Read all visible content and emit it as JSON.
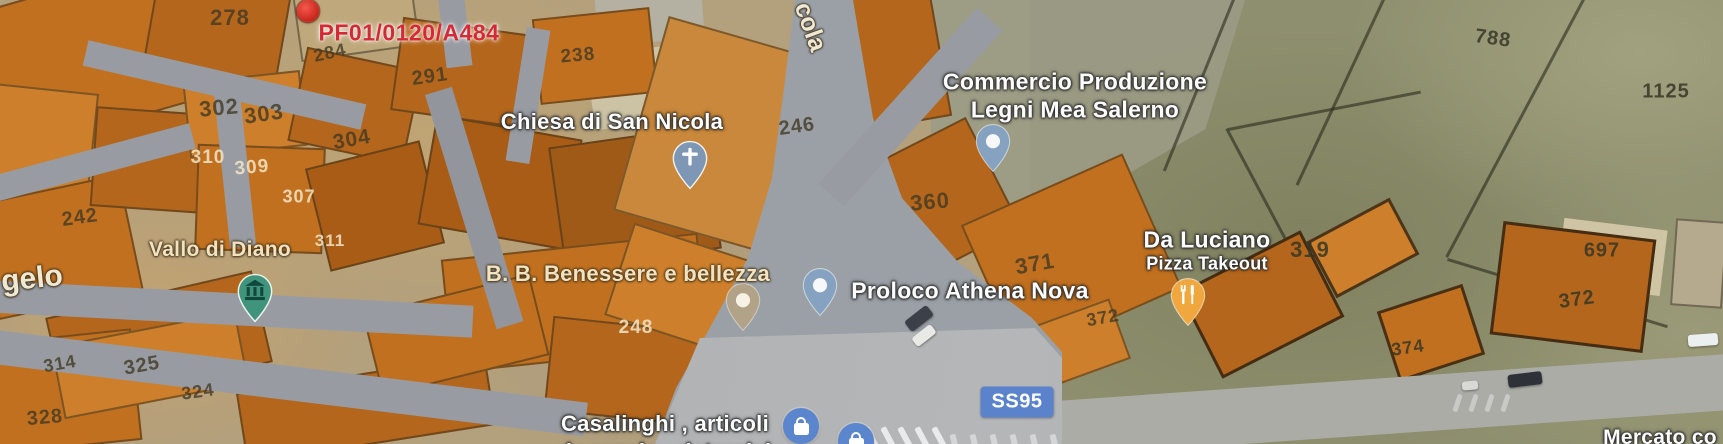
{
  "map": {
    "annotation": {
      "label": "PF01/0120/A484",
      "x": 409,
      "y": 33
    },
    "marker_red": {
      "x": 308,
      "y": 11
    },
    "road_badge": {
      "text": "SS95",
      "x": 1017,
      "y": 402
    },
    "colors": {
      "selected_label": "#d42a35",
      "road_badge_bg": "#5b83cb",
      "shop_icon_bg": "#5b85cd",
      "restaurant_pin": "#efa73e",
      "museum_pin": "#3f947b",
      "church_pin": "#7e97b5",
      "business_pin": "#85a2c0",
      "area_pin": "#b2a287",
      "parcel_fill": "#c1701f"
    },
    "street_labels": [
      {
        "text": "cola",
        "x": 810,
        "y": 27,
        "size": 25,
        "rot": 70
      },
      {
        "text": "gelo",
        "x": 32,
        "y": 279,
        "size": 30,
        "rot": -6
      }
    ],
    "pois": [
      {
        "id": "chiesa-di-san-nicola",
        "color": "white",
        "lx": 612,
        "lines": [
          {
            "text": "Chiesa di San Nicola",
            "y": 122,
            "size": 22
          }
        ],
        "pin": {
          "type": "church",
          "x": 690,
          "y": 190
        }
      },
      {
        "id": "commercio-produzione-legni-mea-salerno",
        "color": "white",
        "lx": 1075,
        "lines": [
          {
            "text": "Commercio Produzione",
            "y": 82,
            "size": 23
          },
          {
            "text": "Legni Mea Salerno",
            "y": 110,
            "size": 23
          }
        ],
        "pin": {
          "type": "dot-blue",
          "x": 993,
          "y": 173
        }
      },
      {
        "id": "vallo-di-diano",
        "color": "cream",
        "lx": 220,
        "lines": [
          {
            "text": "Vallo di Diano",
            "y": 250,
            "size": 21
          }
        ],
        "pin": {
          "type": "museum",
          "x": 255,
          "y": 323
        }
      },
      {
        "id": "bb-benessere-e-bellezza",
        "color": "cream",
        "lx": 628,
        "lines": [
          {
            "text": "B. B. Benessere e bellezza",
            "y": 274,
            "size": 22
          }
        ],
        "pin": {
          "type": "dot-tan",
          "x": 743,
          "y": 332
        }
      },
      {
        "id": "proloco-athena-nova",
        "color": "white",
        "lx": 970,
        "lines": [
          {
            "text": "Proloco Athena Nova",
            "y": 291,
            "size": 23
          }
        ],
        "pin": {
          "type": "dot-blue",
          "x": 820,
          "y": 317
        }
      },
      {
        "id": "da-luciano",
        "color": "white",
        "lx": 1207,
        "lines": [
          {
            "text": "Da Luciano",
            "y": 240,
            "size": 23
          },
          {
            "text": "Pizza Takeout",
            "y": 264,
            "size": 18
          }
        ],
        "pin": {
          "type": "restaurant",
          "x": 1188,
          "y": 327
        }
      },
      {
        "id": "casalinghi-articoli",
        "color": "white",
        "lx": 665,
        "lines": [
          {
            "text": "Casalinghi , articoli",
            "y": 424,
            "size": 22
          },
          {
            "text": "da regalo , detersivi",
            "y": 452,
            "size": 22
          }
        ],
        "pin": null
      },
      {
        "id": "mercato",
        "color": "white",
        "lx": 1660,
        "lines": [
          {
            "text": "Mercato co",
            "y": 438,
            "size": 21
          }
        ],
        "pin": null
      }
    ],
    "shop_icons": [
      {
        "x": 801,
        "y": 426
      },
      {
        "x": 856,
        "y": 441
      }
    ],
    "parcel_numbers": [
      {
        "t": "278",
        "x": 230,
        "y": 18,
        "s": 22,
        "c": "d",
        "r": 0
      },
      {
        "t": "302",
        "x": 219,
        "y": 108,
        "s": 22,
        "c": "d",
        "r": -5
      },
      {
        "t": "303",
        "x": 264,
        "y": 114,
        "s": 22,
        "c": "d",
        "r": -8
      },
      {
        "t": "310",
        "x": 208,
        "y": 158,
        "s": 19,
        "c": "l",
        "r": 0
      },
      {
        "t": "309",
        "x": 252,
        "y": 168,
        "s": 19,
        "c": "l",
        "r": -5
      },
      {
        "t": "307",
        "x": 299,
        "y": 197,
        "s": 18,
        "c": "l",
        "r": 0
      },
      {
        "t": "304",
        "x": 352,
        "y": 140,
        "s": 21,
        "c": "d",
        "r": -10
      },
      {
        "t": "311",
        "x": 330,
        "y": 241,
        "s": 17,
        "c": "l",
        "r": 0
      },
      {
        "t": "284",
        "x": 330,
        "y": 53,
        "s": 18,
        "c": "d",
        "r": -12
      },
      {
        "t": "291",
        "x": 430,
        "y": 77,
        "s": 20,
        "c": "d",
        "r": -8
      },
      {
        "t": "238",
        "x": 578,
        "y": 56,
        "s": 19,
        "c": "d",
        "r": -5
      },
      {
        "t": "246",
        "x": 797,
        "y": 127,
        "s": 20,
        "c": "d",
        "r": -8
      },
      {
        "t": "248",
        "x": 636,
        "y": 328,
        "s": 19,
        "c": "l",
        "r": 0
      },
      {
        "t": "242",
        "x": 80,
        "y": 218,
        "s": 20,
        "c": "d",
        "r": -8
      },
      {
        "t": "314",
        "x": 60,
        "y": 364,
        "s": 18,
        "c": "d",
        "r": -10
      },
      {
        "t": "325",
        "x": 142,
        "y": 366,
        "s": 20,
        "c": "d",
        "r": -10
      },
      {
        "t": "324",
        "x": 198,
        "y": 392,
        "s": 18,
        "c": "d",
        "r": -8
      },
      {
        "t": "328",
        "x": 45,
        "y": 418,
        "s": 20,
        "c": "d",
        "r": -5
      },
      {
        "t": "360",
        "x": 930,
        "y": 202,
        "s": 22,
        "c": "d",
        "r": -5
      },
      {
        "t": "371",
        "x": 1035,
        "y": 264,
        "s": 22,
        "c": "d",
        "r": -10
      },
      {
        "t": "372",
        "x": 1103,
        "y": 318,
        "s": 18,
        "c": "d",
        "r": -10
      },
      {
        "t": "319",
        "x": 1310,
        "y": 250,
        "s": 22,
        "c": "f",
        "r": 0
      },
      {
        "t": "788",
        "x": 1493,
        "y": 39,
        "s": 20,
        "c": "f",
        "r": 8
      },
      {
        "t": "1125",
        "x": 1666,
        "y": 92,
        "s": 20,
        "c": "f",
        "r": 0
      },
      {
        "t": "697",
        "x": 1602,
        "y": 251,
        "s": 20,
        "c": "f",
        "r": 0
      },
      {
        "t": "372",
        "x": 1577,
        "y": 300,
        "s": 20,
        "c": "f",
        "r": -8
      },
      {
        "t": "374",
        "x": 1408,
        "y": 348,
        "s": 18,
        "c": "f",
        "r": -8
      }
    ]
  }
}
